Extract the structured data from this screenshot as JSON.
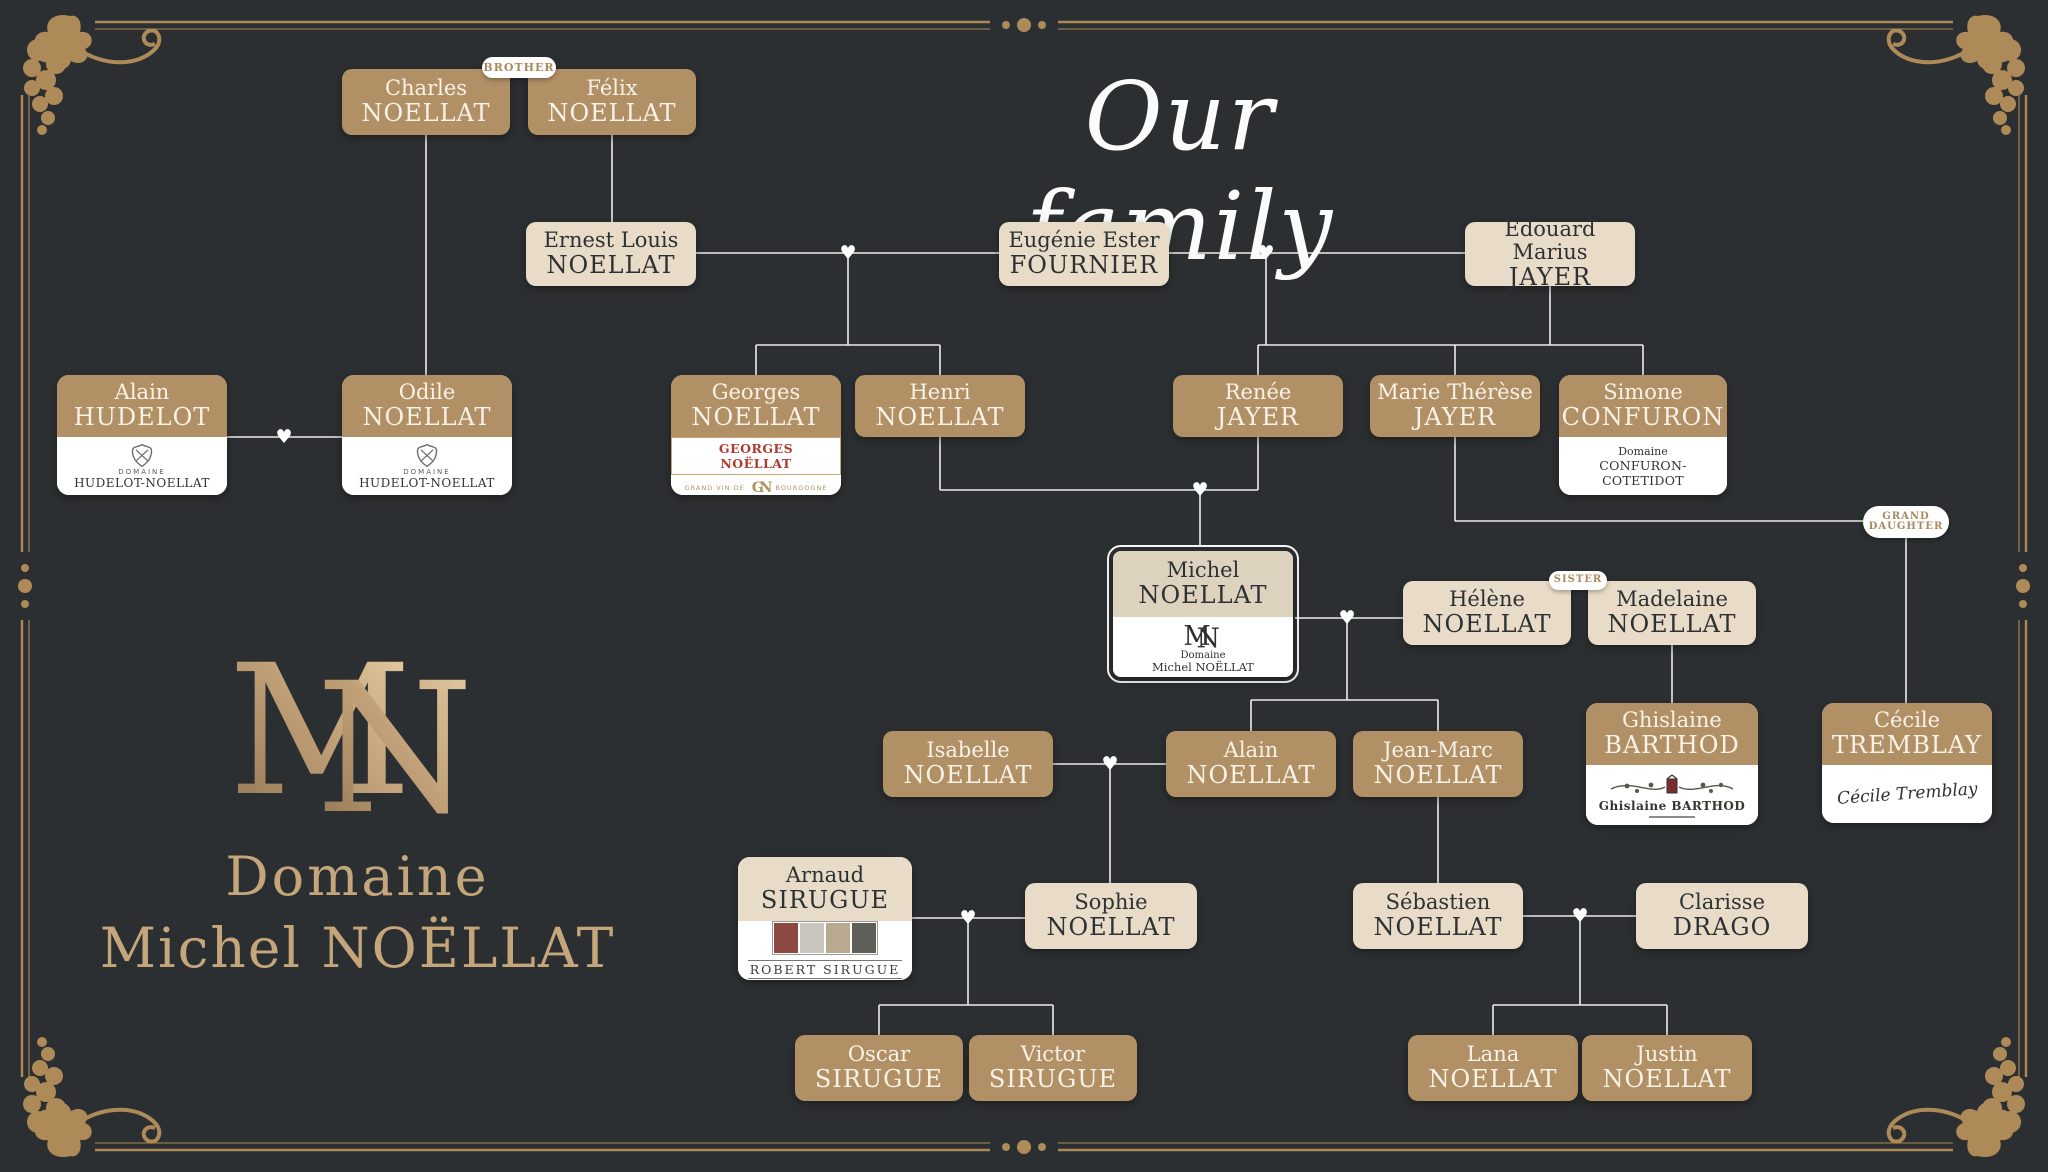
{
  "title": "Our family",
  "brand": {
    "monogram_m": "M",
    "monogram_n": "N",
    "domaine": "Domaine",
    "name": "Michel NOËLLAT"
  },
  "badges": {
    "brother": "BROTHER",
    "sister": "SISTER",
    "grand_daughter_line1": "GRAND",
    "grand_daughter_line2": "DAUGHTER"
  },
  "icons": {
    "heart": "♥"
  },
  "colors": {
    "background": "#2c2f31",
    "tan": "#b19066",
    "beige": "#e8dcc8",
    "gold": "#ad8a58",
    "line": "#ececec",
    "label_red": "#b03a30",
    "white": "#ffffff"
  },
  "persons": {
    "charles": {
      "first": "Charles",
      "last": "NOELLAT"
    },
    "felix": {
      "first": "Félix",
      "last": "NOELLAT"
    },
    "ernest": {
      "first": "Ernest Louis",
      "last": "NOELLAT"
    },
    "eugenie": {
      "first": "Eugénie Ester",
      "last": "FOURNIER"
    },
    "edouard": {
      "first": "Edouard Marius",
      "last": "JAYER"
    },
    "alain_hudelot": {
      "first": "Alain",
      "last": "HUDELOT"
    },
    "odile": {
      "first": "Odile",
      "last": "NOELLAT"
    },
    "georges": {
      "first": "Georges",
      "last": "NOELLAT"
    },
    "henri": {
      "first": "Henri",
      "last": "NOELLAT"
    },
    "renee": {
      "first": "Renée",
      "last": "JAYER"
    },
    "marie_therese": {
      "first": "Marie Thérèse",
      "last": "JAYER"
    },
    "simone": {
      "first": "Simone",
      "last": "CONFURON"
    },
    "michel": {
      "first": "Michel",
      "last": "NOELLAT"
    },
    "helene": {
      "first": "Hélène",
      "last": "NOELLAT"
    },
    "madelaine": {
      "first": "Madelaine",
      "last": "NOELLAT"
    },
    "ghislaine": {
      "first": "Ghislaine",
      "last": "BARTHOD"
    },
    "cecile": {
      "first": "Cécile",
      "last": "TREMBLAY"
    },
    "isabelle": {
      "first": "Isabelle",
      "last": "NOELLAT"
    },
    "alain": {
      "first": "Alain",
      "last": "NOELLAT"
    },
    "jean_marc": {
      "first": "Jean-Marc",
      "last": "NOELLAT"
    },
    "arnaud": {
      "first": "Arnaud",
      "last": "SIRUGUE"
    },
    "sophie": {
      "first": "Sophie",
      "last": "NOELLAT"
    },
    "sebastien": {
      "first": "Sébastien",
      "last": "NOELLAT"
    },
    "clarisse": {
      "first": "Clarisse",
      "last": "DRAGO"
    },
    "oscar": {
      "first": "Oscar",
      "last": "SIRUGUE"
    },
    "victor": {
      "first": "Victor",
      "last": "SIRUGUE"
    },
    "lana": {
      "first": "Lana",
      "last": "NOELLAT"
    },
    "justin": {
      "first": "Justin",
      "last": "NOELLAT"
    }
  },
  "logos": {
    "hudelot": {
      "domaine": "DOMAINE",
      "name": "HUDELOT-NOELLAT"
    },
    "georges": {
      "label": "GEORGES NOËLLAT",
      "left": "GRAND VIN DE",
      "mono": "GN",
      "right": "BOURGOGNE"
    },
    "confuron": {
      "domaine": "Domaine",
      "name": "CONFURON-COTETIDOT"
    },
    "michel": {
      "domaine": "Domaine",
      "name": "Michel NOËLLAT"
    },
    "barthod": {
      "name": "Ghislaine BARTHOD"
    },
    "sirugue": {
      "name": "ROBERT SIRUGUE"
    },
    "tremblay": {
      "signature": "Cécile Tremblay"
    }
  }
}
